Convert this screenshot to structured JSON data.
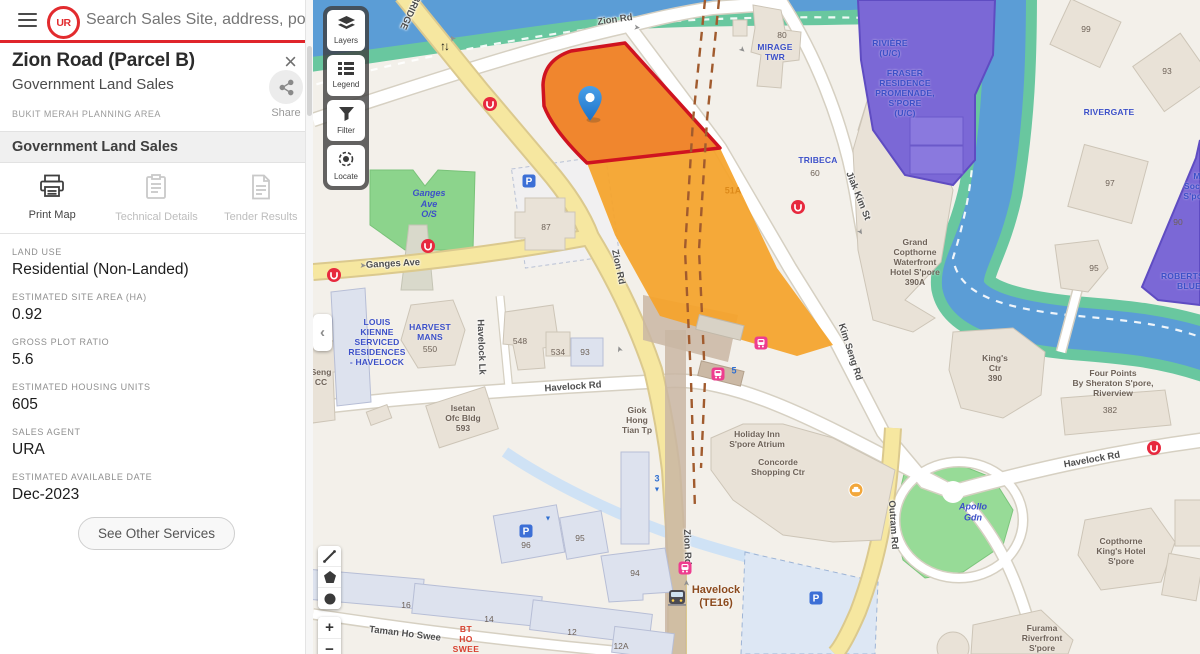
{
  "header": {
    "logo_text": "UR",
    "search_placeholder": "Search Sales Site, address, postal code"
  },
  "panel": {
    "title": "Zion Road (Parcel B)",
    "subtitle": "Government Land Sales",
    "planning_area": "BUKIT MERAH PLANNING AREA",
    "close_glyph": "×",
    "share_label": "Share",
    "section_title": "Government Land Sales",
    "actions": [
      {
        "label": "Print Map",
        "icon": "printer-icon",
        "enabled": true
      },
      {
        "label": "Technical Details",
        "icon": "clipboard-icon",
        "enabled": false
      },
      {
        "label": "Tender Results",
        "icon": "document-icon",
        "enabled": false
      }
    ],
    "fields": [
      {
        "label": "LAND USE",
        "value": "Residential (Non-Landed)"
      },
      {
        "label": "ESTIMATED SITE AREA (HA)",
        "value": "0.92"
      },
      {
        "label": "GROSS PLOT RATIO",
        "value": "5.6"
      },
      {
        "label": "ESTIMATED HOUSING UNITS",
        "value": "605"
      },
      {
        "label": "SALES AGENT",
        "value": "URA"
      },
      {
        "label": "ESTIMATED AVAILABLE DATE",
        "value": "Dec-2023"
      }
    ],
    "other_services_label": "See Other Services"
  },
  "map": {
    "collapse_glyph": "‹",
    "zoom_in_label": "+",
    "zoom_out_label": "−",
    "controls": [
      {
        "label": "Layers",
        "icon": "layers-icon"
      },
      {
        "label": "Legend",
        "icon": "legend-icon"
      },
      {
        "label": "Filter",
        "icon": "filter-icon"
      },
      {
        "label": "Locate",
        "icon": "locate-icon"
      }
    ],
    "tools": [
      {
        "name": "measure-tool",
        "glyph": "measure"
      },
      {
        "name": "polygon-tool",
        "glyph": "polygon"
      },
      {
        "name": "circle-tool",
        "glyph": "circle"
      }
    ],
    "colors": {
      "parcel_fill": "#F0862E",
      "parcel_border": "#CF1320",
      "parcel_adjacent": "#F5A329",
      "private_parcel": "#7B68D6",
      "water": "#5B9DD6",
      "park": "#97DB97",
      "road_yellow": "#F6E7A0",
      "mrt_brown": "#8C4A1D",
      "accent_red": "#E0252B"
    },
    "labels": [
      {
        "t": "Zion Rd",
        "x": 302,
        "y": 20,
        "k": "road",
        "r": -8
      },
      {
        "t": "BRIDGE",
        "x": 97,
        "y": 12,
        "k": "road",
        "r": 115
      },
      {
        "t": "Jiak Kim St",
        "x": 545,
        "y": 196,
        "k": "road",
        "r": 68
      },
      {
        "t": "Kim Seng Rd",
        "x": 537,
        "y": 352,
        "k": "road",
        "r": 72
      },
      {
        "t": "Havelock Rd",
        "x": 260,
        "y": 387,
        "k": "road",
        "r": -4
      },
      {
        "t": "Havelock Rd",
        "x": 779,
        "y": 460,
        "k": "road",
        "r": -10
      },
      {
        "t": "Outram Rd",
        "x": 580,
        "y": 525,
        "k": "road",
        "r": 86
      },
      {
        "t": "Ganges Ave",
        "x": 80,
        "y": 264,
        "k": "road",
        "r": -3
      },
      {
        "t": "Havelock Lk",
        "x": 168,
        "y": 347,
        "k": "road",
        "r": 88
      },
      {
        "t": "Taman Ho Swee",
        "x": 92,
        "y": 634,
        "k": "road",
        "r": 7
      },
      {
        "t": "Zion Rd",
        "x": 305,
        "y": 267,
        "k": "road",
        "r": 78
      },
      {
        "t": "Zion Rd",
        "x": 374,
        "y": 547,
        "k": "road",
        "r": 88
      },
      {
        "t": "RIVIÈRE\n(U/C)",
        "x": 577,
        "y": 48,
        "k": "condo"
      },
      {
        "t": "FRASER\nRESIDENCE\nPROMENADE,\nS'PORE\n(U/C)",
        "x": 592,
        "y": 93,
        "k": "condo"
      },
      {
        "t": "RIVERGATE",
        "x": 796,
        "y": 112,
        "k": "condo"
      },
      {
        "t": "MIRAGE\nTWR",
        "x": 462,
        "y": 52,
        "k": "condo"
      },
      {
        "t": "TRIBECA",
        "x": 505,
        "y": 160,
        "k": "condo"
      },
      {
        "t": "ROBERTSON\nBLUE",
        "x": 876,
        "y": 281,
        "k": "condo"
      },
      {
        "t": "M Social\nS'pore",
        "x": 884,
        "y": 186,
        "k": "condo"
      },
      {
        "t": "Apollo\nGdn",
        "x": 660,
        "y": 512,
        "k": "area"
      },
      {
        "t": "Ganges\nAve\nO/S",
        "x": 116,
        "y": 204,
        "k": "area"
      },
      {
        "t": "LOUIS\nKIENNE\nSERVICED\nRESIDENCES\n- HAVELOCK",
        "x": 64,
        "y": 342,
        "k": "condo"
      },
      {
        "t": "HARVEST\nMANS",
        "x": 117,
        "y": 332,
        "k": "condo"
      },
      {
        "t": "Grand\nCopthorne\nWaterfront\nHotel S'pore\n390A",
        "x": 602,
        "y": 262,
        "k": "bldg"
      },
      {
        "t": "King's\nCtr\n390",
        "x": 682,
        "y": 368,
        "k": "bldg"
      },
      {
        "t": "Four Points\nBy Sheraton S'pore,\nRiverview",
        "x": 800,
        "y": 383,
        "k": "bldg"
      },
      {
        "t": "Copthorne\nKing's Hotel\nS'pore",
        "x": 808,
        "y": 551,
        "k": "bldg"
      },
      {
        "t": "Furama\nRiverfront\nS'pore",
        "x": 729,
        "y": 638,
        "k": "bldg"
      },
      {
        "t": "Holiday Inn\nS'pore Atrium",
        "x": 444,
        "y": 439,
        "k": "bldg"
      },
      {
        "t": "Concorde\nShopping Ctr",
        "x": 465,
        "y": 467,
        "k": "bldg"
      },
      {
        "t": "Giok\nHong\nTian Tp",
        "x": 324,
        "y": 420,
        "k": "bldg"
      },
      {
        "t": "Isetan\nOfc Bldg\n593",
        "x": 150,
        "y": 418,
        "k": "bldg"
      },
      {
        "t": "Seng\nCC",
        "x": 8,
        "y": 377,
        "k": "bldg"
      },
      {
        "t": "Havelock\n(TE16)",
        "x": 403,
        "y": 597,
        "k": "mrt"
      },
      {
        "t": "BT\nHO\nSWEE",
        "x": 153,
        "y": 639,
        "k": "red"
      },
      {
        "t": "51A",
        "x": 420,
        "y": 191,
        "k": "orange"
      },
      {
        "t": "5",
        "x": 421,
        "y": 371,
        "k": "blue5"
      },
      {
        "t": "3",
        "x": 344,
        "y": 479,
        "k": "blue5"
      },
      {
        "t": "80",
        "x": 469,
        "y": 35,
        "k": "num"
      },
      {
        "t": "60",
        "x": 502,
        "y": 173,
        "k": "num"
      },
      {
        "t": "99",
        "x": 773,
        "y": 29,
        "k": "num"
      },
      {
        "t": "93",
        "x": 854,
        "y": 71,
        "k": "num"
      },
      {
        "t": "97",
        "x": 797,
        "y": 183,
        "k": "num"
      },
      {
        "t": "95",
        "x": 781,
        "y": 268,
        "k": "num"
      },
      {
        "t": "90",
        "x": 865,
        "y": 222,
        "k": "num"
      },
      {
        "t": "382",
        "x": 797,
        "y": 410,
        "k": "num"
      },
      {
        "t": "87",
        "x": 233,
        "y": 227,
        "k": "num"
      },
      {
        "t": "548",
        "x": 207,
        "y": 341,
        "k": "num"
      },
      {
        "t": "534",
        "x": 245,
        "y": 352,
        "k": "num"
      },
      {
        "t": "93",
        "x": 272,
        "y": 352,
        "k": "num"
      },
      {
        "t": "550",
        "x": 117,
        "y": 349,
        "k": "num"
      },
      {
        "t": "94",
        "x": 322,
        "y": 573,
        "k": "num"
      },
      {
        "t": "96",
        "x": 213,
        "y": 545,
        "k": "num"
      },
      {
        "t": "95",
        "x": 267,
        "y": 538,
        "k": "num"
      },
      {
        "t": "16",
        "x": 93,
        "y": 605,
        "k": "num"
      },
      {
        "t": "14",
        "x": 176,
        "y": 619,
        "k": "num"
      },
      {
        "t": "12",
        "x": 259,
        "y": 632,
        "k": "num"
      },
      {
        "t": "12A",
        "x": 308,
        "y": 646,
        "k": "num"
      }
    ],
    "markers": [
      {
        "kind": "pin",
        "x": 277,
        "y": 104
      },
      {
        "kind": "ura-badge",
        "x": 177,
        "y": 104
      },
      {
        "kind": "ura-badge",
        "x": 485,
        "y": 207
      },
      {
        "kind": "ura-badge",
        "x": 21,
        "y": 275
      },
      {
        "kind": "ura-badge",
        "x": 115,
        "y": 246
      },
      {
        "kind": "ura-badge",
        "x": 841,
        "y": 448
      },
      {
        "kind": "tel-station",
        "x": 405,
        "y": 374
      },
      {
        "kind": "tel-station",
        "x": 448,
        "y": 343
      },
      {
        "kind": "tel-station",
        "x": 372,
        "y": 568
      },
      {
        "kind": "mrt-train",
        "x": 364,
        "y": 598
      },
      {
        "kind": "parking",
        "x": 216,
        "y": 181
      },
      {
        "kind": "parking",
        "x": 213,
        "y": 531
      },
      {
        "kind": "parking",
        "x": 503,
        "y": 598
      },
      {
        "kind": "taxi",
        "x": 543,
        "y": 490
      },
      {
        "kind": "two-way-arrows",
        "x": 131,
        "y": 46
      },
      {
        "kind": "blue-triangle",
        "x": 235,
        "y": 519
      },
      {
        "kind": "blue-triangle",
        "x": 344,
        "y": 490
      },
      {
        "kind": "road-arrow",
        "x": 324,
        "y": 28,
        "r": 8
      },
      {
        "kind": "road-arrow",
        "x": 140,
        "y": 38,
        "r": -125
      },
      {
        "kind": "road-arrow",
        "x": 429,
        "y": 50,
        "r": 42
      },
      {
        "kind": "road-arrow",
        "x": 547,
        "y": 232,
        "r": 58
      },
      {
        "kind": "road-arrow",
        "x": 307,
        "y": 349,
        "r": -110
      },
      {
        "kind": "road-arrow",
        "x": 374,
        "y": 583,
        "r": -90
      },
      {
        "kind": "road-arrow",
        "x": 50,
        "y": 266,
        "r": 2
      }
    ]
  }
}
